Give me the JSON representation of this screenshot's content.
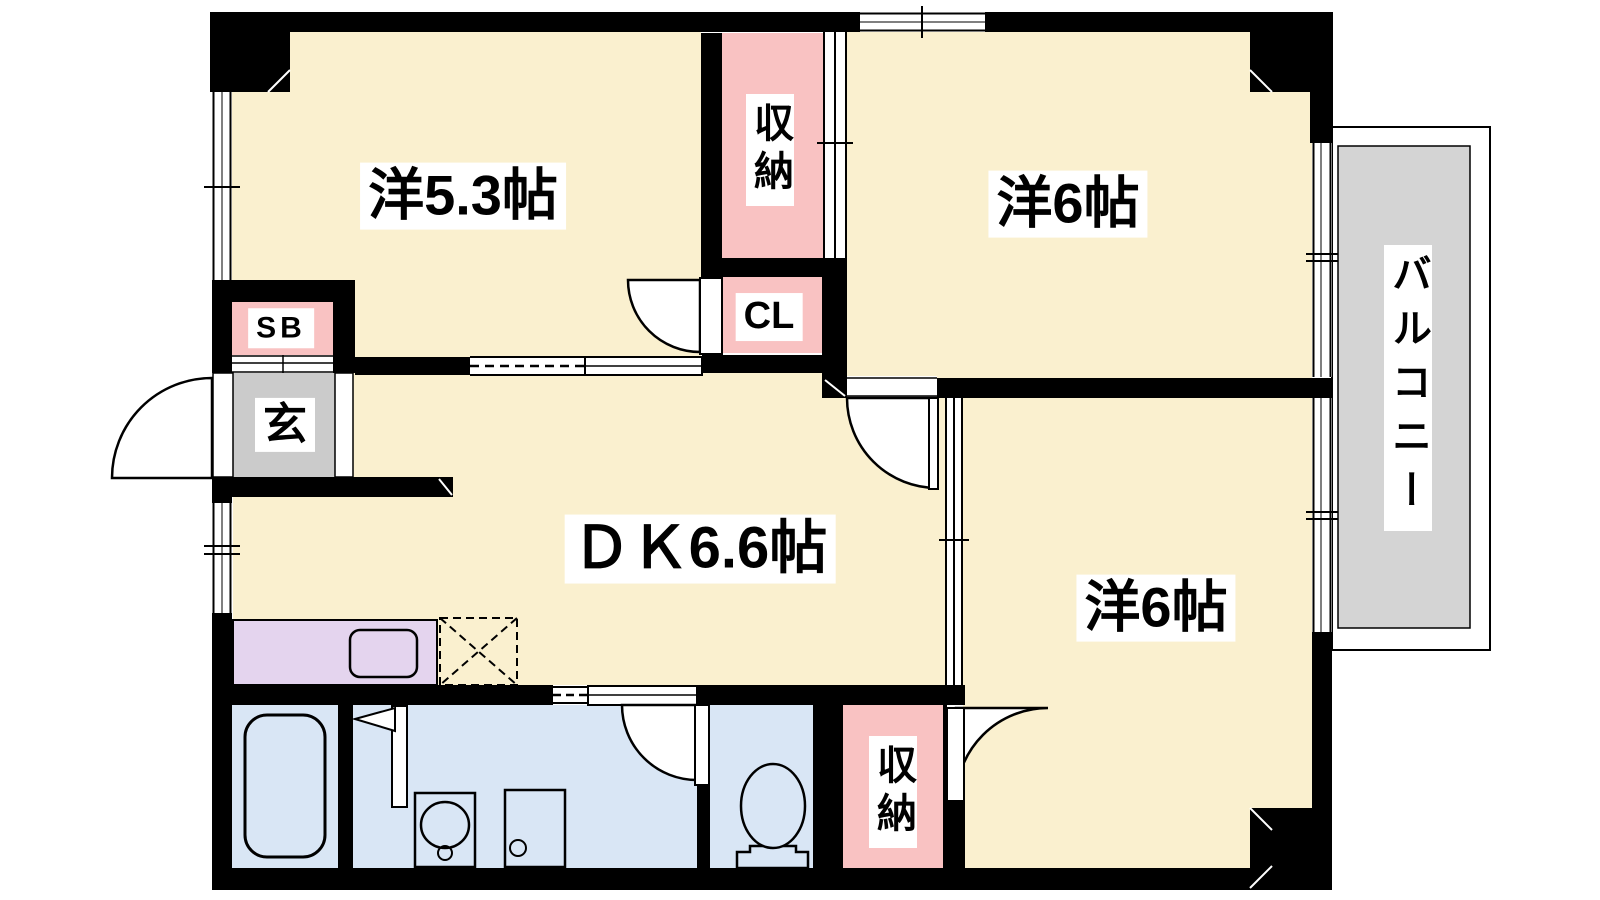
{
  "colors": {
    "floor": "#FAF0CF",
    "storage": "#F9C2C2",
    "wet_area": "#D9E6F5",
    "kitchen_counter": "#E4D4EE",
    "entrance_floor": "#CBCBCB",
    "balcony_floor": "#D4D4D4",
    "wall": "#000000",
    "background": "#FFFFFF"
  },
  "rooms": [
    {
      "id": "western_5_3",
      "label": "洋5.3帖"
    },
    {
      "id": "western_6_upper",
      "label": "洋6帖"
    },
    {
      "id": "western_6_lower",
      "label": "洋6帖"
    },
    {
      "id": "dining_kitchen",
      "label": "ＤＫ6.6帖"
    },
    {
      "id": "storage_upper",
      "label": "収納"
    },
    {
      "id": "storage_lower",
      "label": "収納"
    },
    {
      "id": "closet",
      "label": "CL"
    },
    {
      "id": "shoe_box",
      "label": "SB"
    },
    {
      "id": "entrance",
      "label": "玄"
    },
    {
      "id": "balcony",
      "label": "バルコニー"
    }
  ],
  "fixtures": [
    "bathtub",
    "kitchen-sink",
    "refrigerator-space",
    "washbasin",
    "washing-machine-pan",
    "toilet",
    "entrance-door",
    "sliding-doors",
    "windows"
  ]
}
